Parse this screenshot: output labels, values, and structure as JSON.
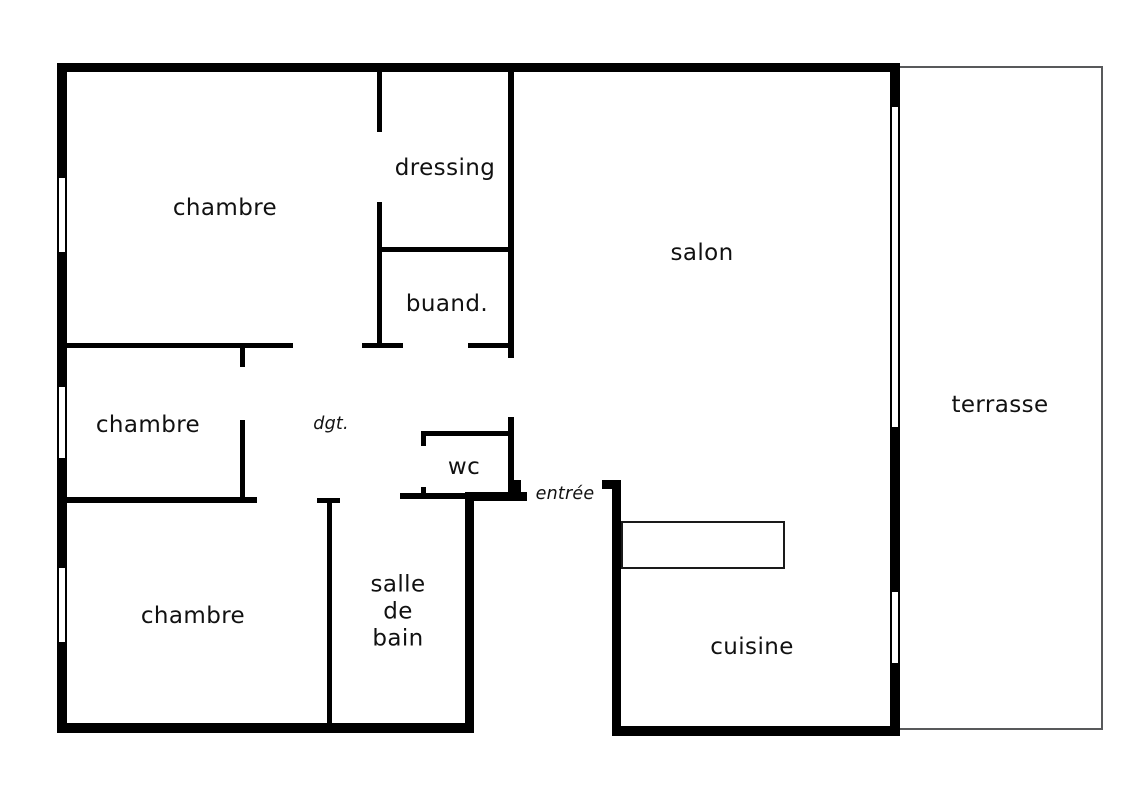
{
  "title": "floor-plan",
  "rooms": {
    "bedroom_top": "chambre",
    "bedroom_middle": "chambre",
    "bedroom_bottom": "chambre",
    "dressing": "dressing",
    "laundry": "buand.",
    "living_room": "salon",
    "terrace": "terrasse",
    "wc": "wc",
    "bathroom_lines": [
      "salle",
      "de",
      "bain"
    ],
    "kitchen": "cuisine",
    "hallway": "dgt.",
    "entrance": "entrée"
  },
  "colors": {
    "wall": "#000000",
    "text": "#111111",
    "terrace_outline": "#58595b",
    "counter_outline": "#1a1a1a",
    "background": "#ffffff"
  }
}
